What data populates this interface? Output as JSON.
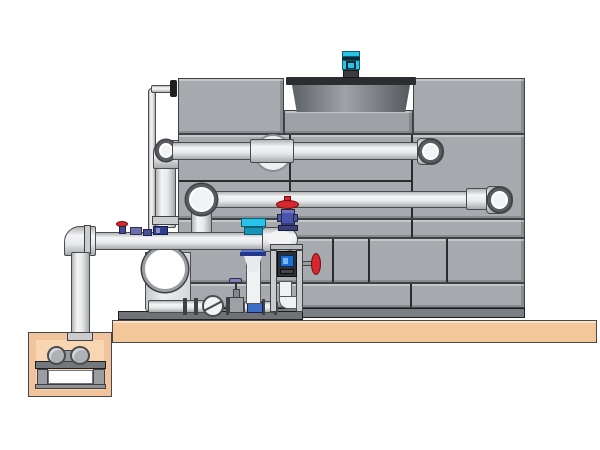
{
  "scene": {
    "type": "technical-illustration",
    "subject": "closed-circuit cooling tower with fan cowl, piping, pump skid and sump pit",
    "view": "side-elevation",
    "background": "#ffffff"
  },
  "palette": {
    "panel_gray": "#a6a9ad",
    "panel_base_gray": "#7b7e83",
    "cowl_lip_dark": "#2b2d30",
    "notch_floor_gray": "#9ea1a5",
    "platform_tan": "#f4c79a",
    "pit_wall_tan": "#f2c49e",
    "pit_inner_tan": "#f8d6b2",
    "pit_recess_white": "#ffffff",
    "stand_gray": "#74777b",
    "pump_steel": "#aeb1b5",
    "pump_face_white": "#ffffff",
    "motor_cyan": "#27c3e9",
    "motor_band_dark": "#0e2a33",
    "motor_base_dark": "#3a3d40",
    "valve_red": "#d6262e",
    "valve_navy_body": "#4a54a8",
    "valve_navy_flange": "#3a3f77",
    "fitting_blue": "#3f6fc4",
    "fitting_purple": "#6b6fae",
    "fitting_deep_navy": "#2e3f90",
    "flange_navy_top": "#2b4aa0",
    "flange_navy_mid": "#5a77c9",
    "flange_navy_bot": "#23388c",
    "device_screen_blue": "#1b6fd4",
    "device_box_dark": "#2e3033",
    "cyan_valve_lower": "#1893b8",
    "pipe_white": "#f0f1f2",
    "check_valve_white": "#f2f3f4",
    "gate_valve_gray": "#9da0a4",
    "handle_purple": "#7d81b5",
    "black_flange": "#1e1f21"
  },
  "components": {
    "tower": "cooling tower panel shell",
    "fan_cowl": "recessed fan cowl with dark rim",
    "fan_motor": "cyan fan motor on top",
    "upper_pipe": "upper distribution pipe with end elbow",
    "lower_pipe": "lower distribution pipe with end elbow",
    "header_pipe": "pump suction/discharge header",
    "riser_pipe": "vertical riser with top elbow",
    "sensor_line": "thin instrument line to tower wall",
    "pump": "end-suction centrifugal pump",
    "check_valve": "swing check valve",
    "gate_valve": "gate valve with T-handle",
    "control_valve": "cyan-top control valve with reducer cone",
    "globe_valve": "red handwheel globe valve on header elbow",
    "meter_stand": "instrument stand with meter and elbow pipe",
    "side_valve": "red side handwheel valve",
    "sump_pit": "concrete sump pit",
    "sump_pump": "horizontal sump pump on stand",
    "platform": "concrete platform slab"
  }
}
